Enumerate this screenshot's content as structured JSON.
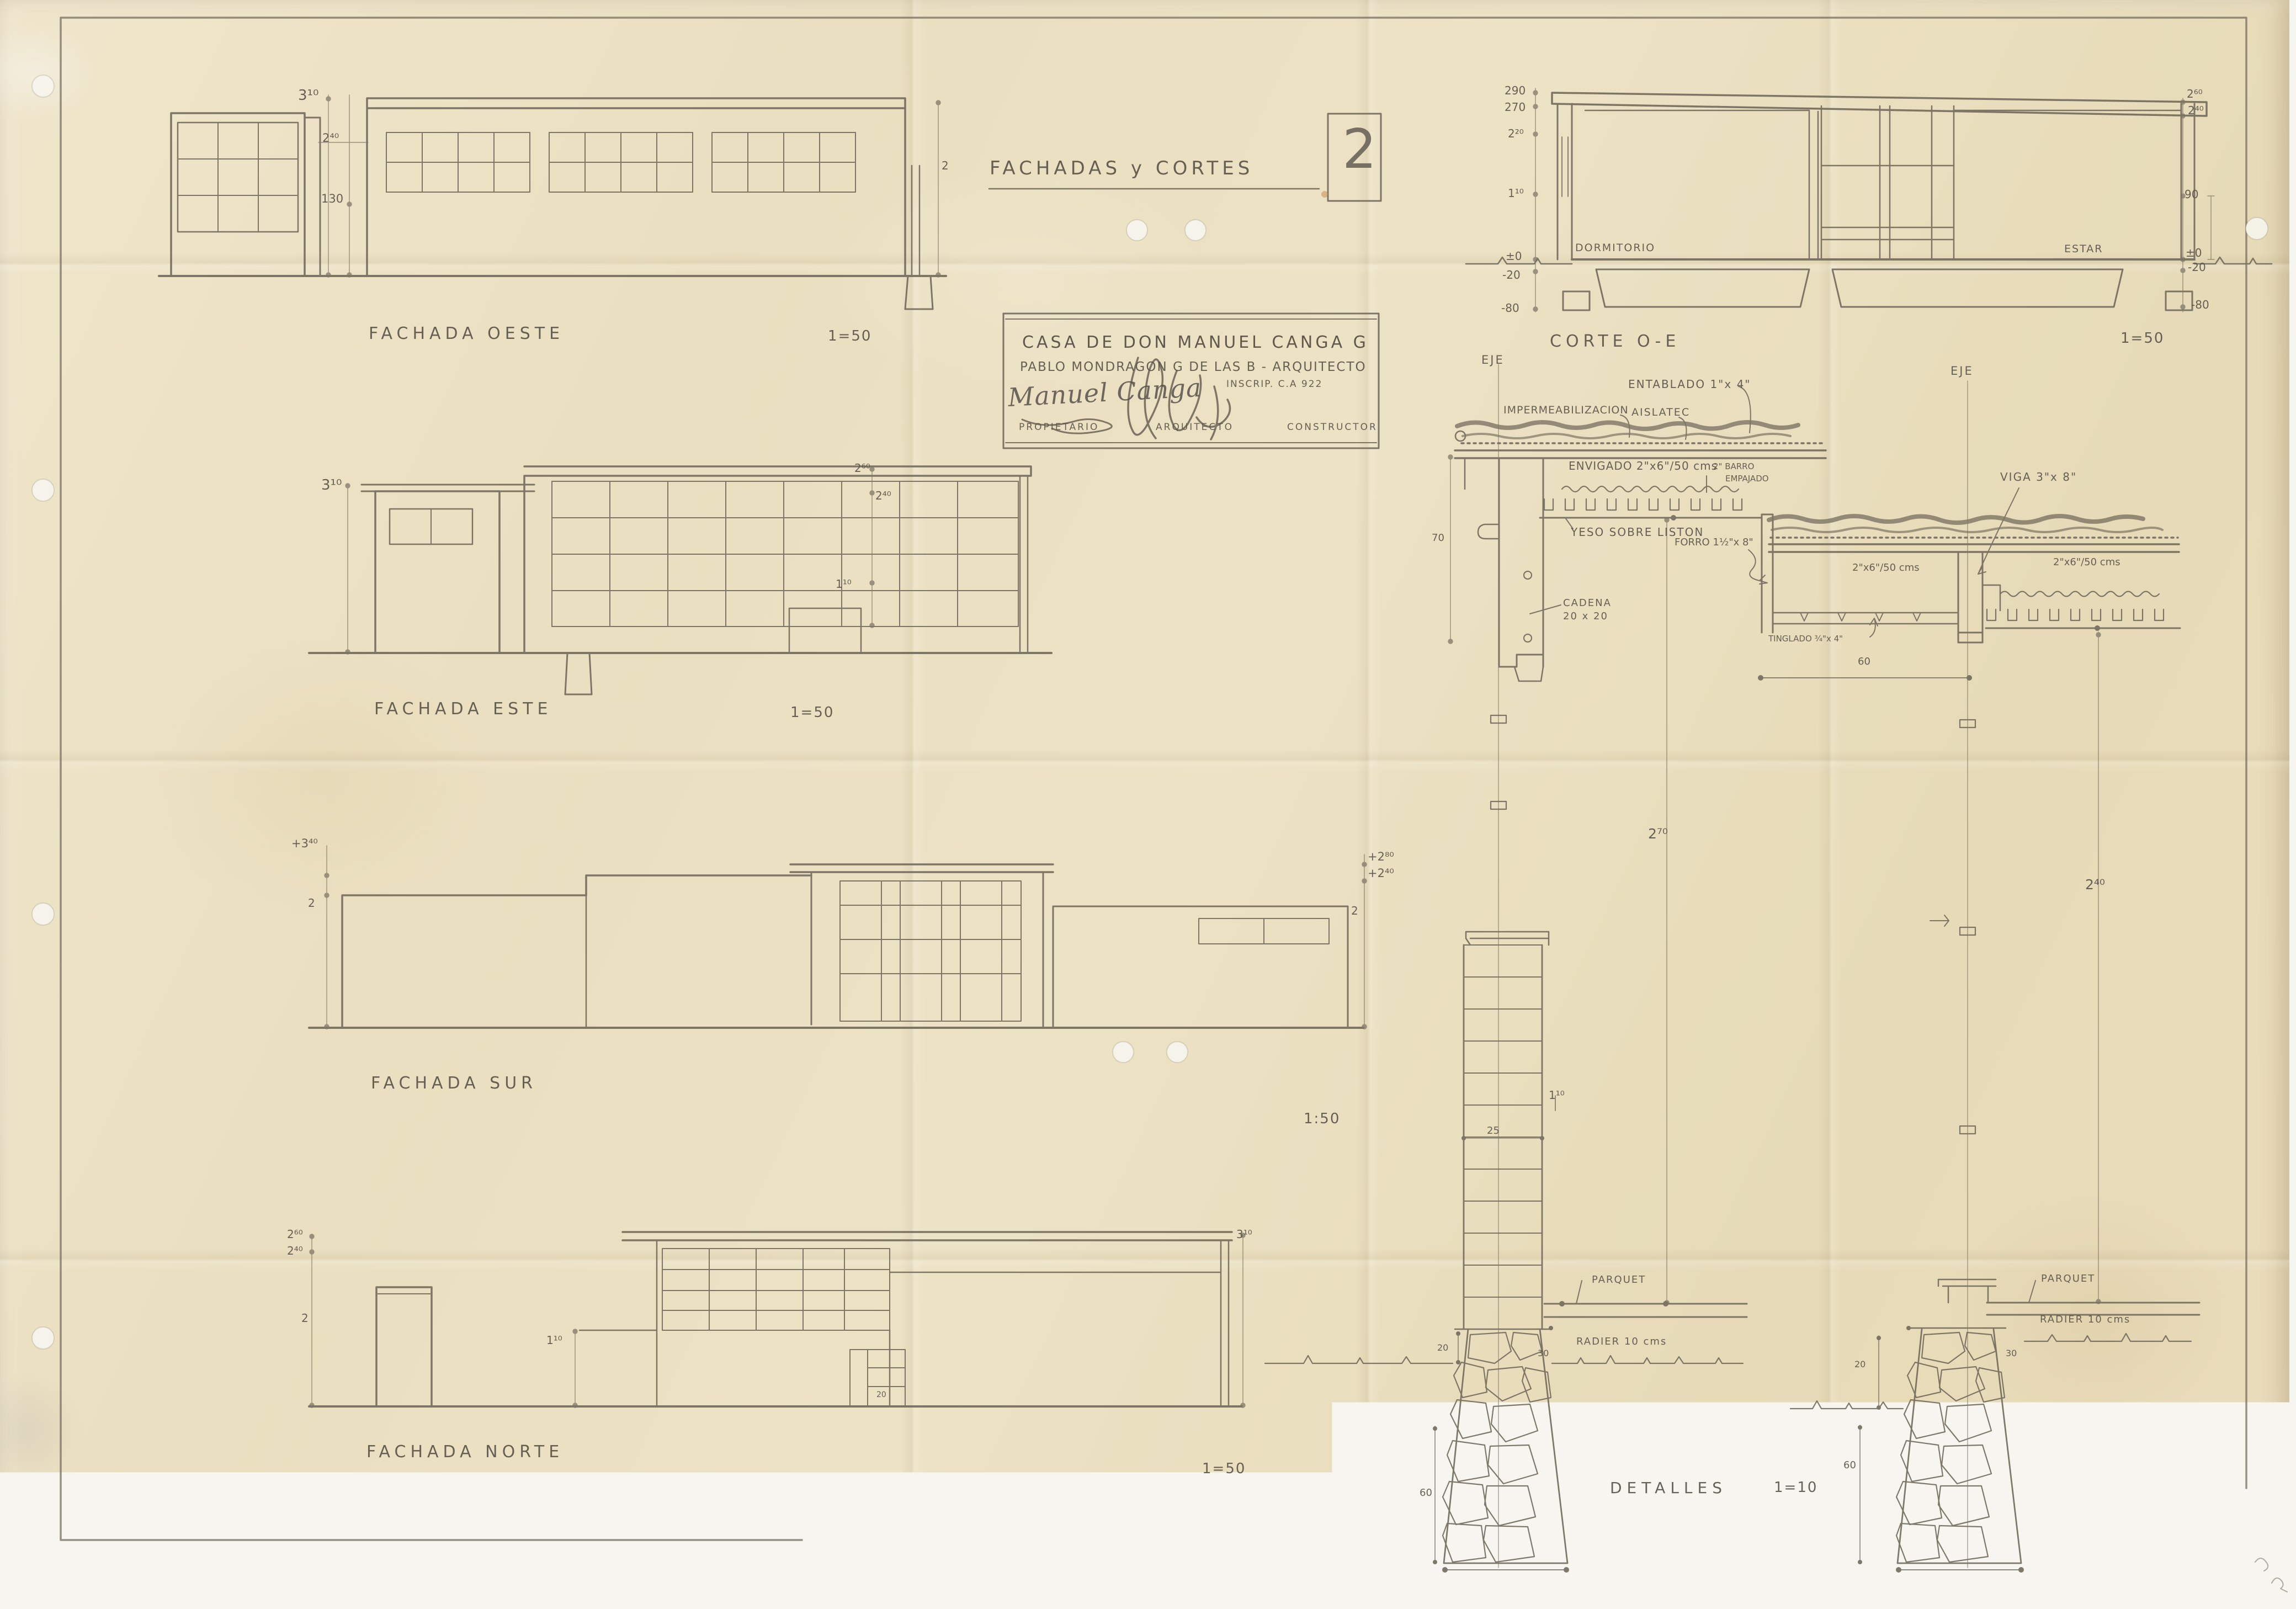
{
  "header": {
    "title": "FACHADAS y CORTES",
    "sheet_number": "2"
  },
  "title_block": {
    "project": "CASA DE DON MANUEL CANGA G",
    "architect_line": "PABLO MONDRAGON G DE LAS B - ARQUITECTO",
    "inscription": "INSCRIP. C.A 922",
    "signature": "Manuel Canga",
    "roles": [
      "PROPIETARIO",
      "ARQUITECTO",
      "CONSTRUCTOR"
    ]
  },
  "fachada_oeste": {
    "label": "FACHADA OESTE",
    "scale": "1=50",
    "dims": {
      "h1": "3¹⁰",
      "h2": "2⁴⁰",
      "h3": "130",
      "right": "2"
    }
  },
  "fachada_este": {
    "label": "FACHADA ESTE",
    "scale": "1=50",
    "dims": {
      "left": "3¹⁰",
      "mid_top": "2⁶⁰",
      "mid": "2⁴⁰",
      "sill": "1¹⁰"
    }
  },
  "fachada_sur": {
    "label": "FACHADA SUR",
    "scale": "1:50",
    "dims": {
      "left_top": "+3⁴⁰",
      "left": "2",
      "right_top": "+2⁸⁰",
      "right_mid": "+2⁴⁰",
      "right": "2"
    }
  },
  "fachada_norte": {
    "label": "FACHADA NORTE",
    "scale": "1=50",
    "dims": {
      "left_top": "2⁶⁰",
      "left_mid": "2⁴⁰",
      "left": "2",
      "porch": "1¹⁰",
      "right_top": "3¹⁰",
      "step": "20"
    }
  },
  "corte": {
    "label": "CORTE O-E",
    "scale": "1=50",
    "axis": "EJE",
    "rooms": [
      "DORMITORIO",
      "ESTAR"
    ],
    "levels_left": [
      "290",
      "270",
      "2²⁰",
      "1¹⁰",
      "±0",
      "-20",
      "-80"
    ],
    "levels_right": [
      "2⁶⁰",
      "2⁴⁰",
      "90",
      "±0",
      "-20",
      "-80"
    ]
  },
  "details": {
    "label": "DETALLES",
    "scale": "1=10",
    "axis": "EJE",
    "d1": {
      "entablado": "ENTABLADO 1\"x 4\"",
      "imper": "IMPERMEABILIZACION",
      "aislatec": "AISLATEC",
      "envigado": "ENVIGADO 2\"x6\"/50 cms",
      "barro1": "2\" BARRO",
      "barro2": "EMPAJADO",
      "yeso": "YESO SOBRE LISTON",
      "cadena1": "CADENA",
      "cadena2": "20 x 20",
      "h70": "70",
      "h270": "2⁷⁰",
      "brick": "25",
      "h110": "1¹⁰",
      "parquet": "PARQUET",
      "radier": "RADIER 10 cms",
      "d20": "20",
      "d30": "30",
      "d60": "60",
      "d40": "40"
    },
    "d2": {
      "viga": "VIGA 3\"x 8\"",
      "forro": "FORRO 1½\"x 8\"",
      "joists_l": "2\"x6\"/50 cms",
      "joists_r": "2\"x6\"/50 cms",
      "tinglado": "TINGLADO ¾\"x 4\"",
      "d60top": "60",
      "h240": "2⁴⁰",
      "parquet": "PARQUET",
      "radier": "RADIER 10 cms",
      "d20": "20",
      "d30": "30",
      "d60": "60",
      "d40": "40"
    }
  }
}
